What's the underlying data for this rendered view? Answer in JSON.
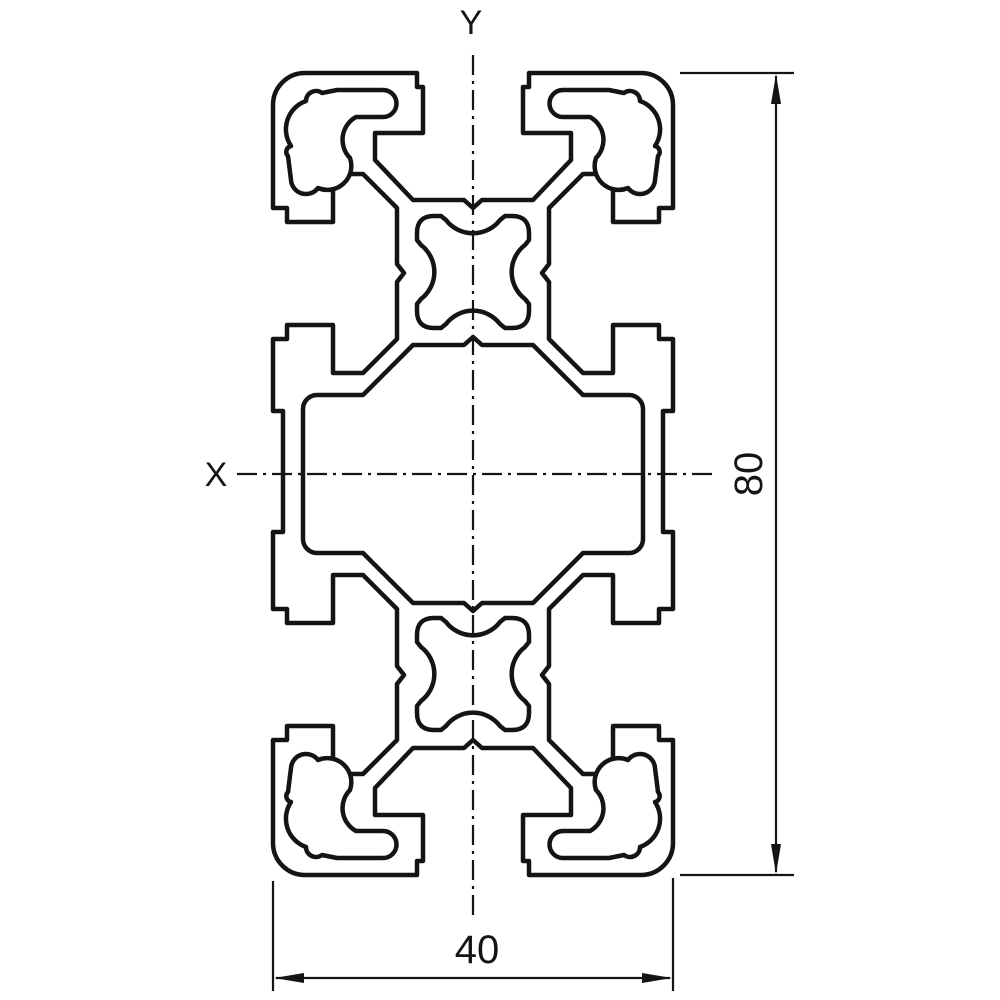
{
  "page": {
    "background": "#ffffff",
    "line_color": "#141414",
    "drawing_type": "aluminum-profile-cross-section"
  },
  "axes": {
    "vertical_label": "Y",
    "horizontal_label": "X"
  },
  "dimensions": {
    "height": {
      "value": "80",
      "orientation": "vertical"
    },
    "width": {
      "value": "40",
      "orientation": "horizontal"
    }
  }
}
